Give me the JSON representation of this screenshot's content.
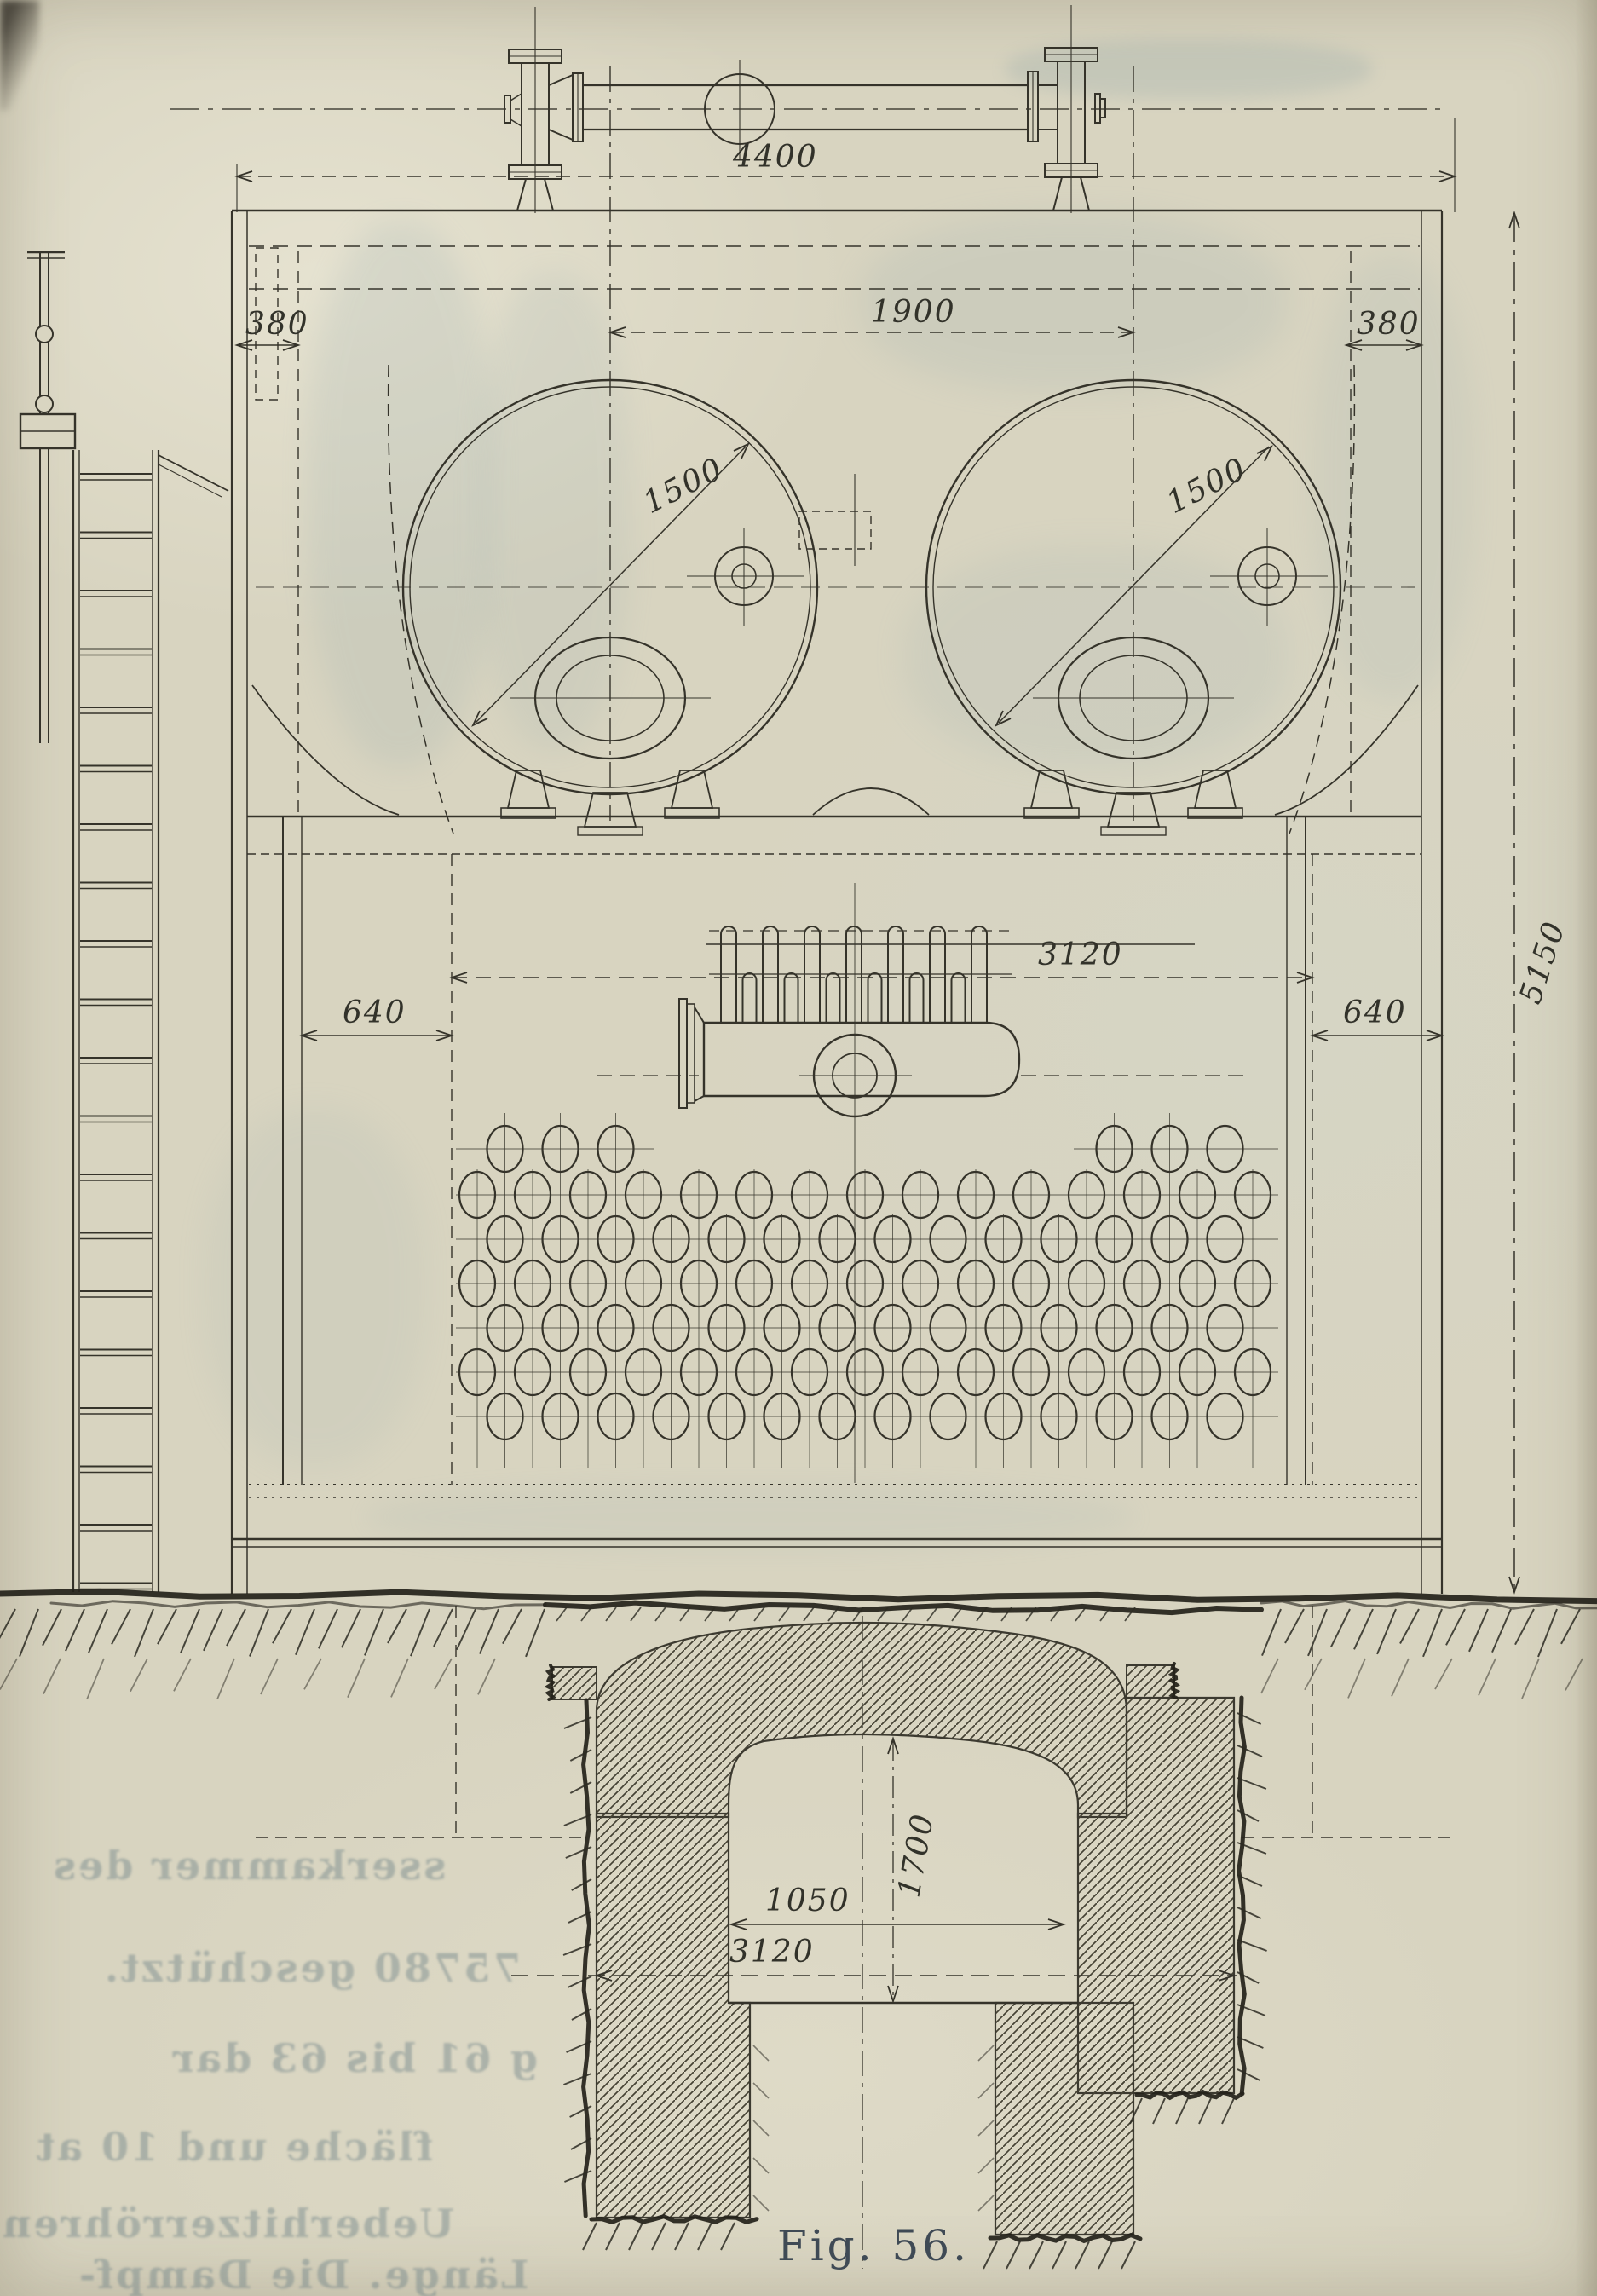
{
  "figure": {
    "caption": "Fig. 56."
  },
  "dimensions": {
    "steam_pipe_length": "4400",
    "drum_spacing": "1900",
    "offset_left": "380",
    "offset_right": "380",
    "drum_diameter_left": "1500",
    "drum_diameter_right": "1500",
    "side_flue_left": "640",
    "side_flue_right": "640",
    "tube_bank_width": "3120",
    "overall_height": "5150",
    "pit_opening_width": "1050",
    "pit_overall_width": "3120",
    "pit_chamber_height": "1700"
  },
  "bleed_through_text": {
    "lines": [
      "sserkammer des",
      "75780 geschützt.",
      "g 61 bis 63 dar",
      "fläche und 10 at",
      "Ueberhitzerröhren",
      "Länge. Die Dampf-"
    ]
  }
}
